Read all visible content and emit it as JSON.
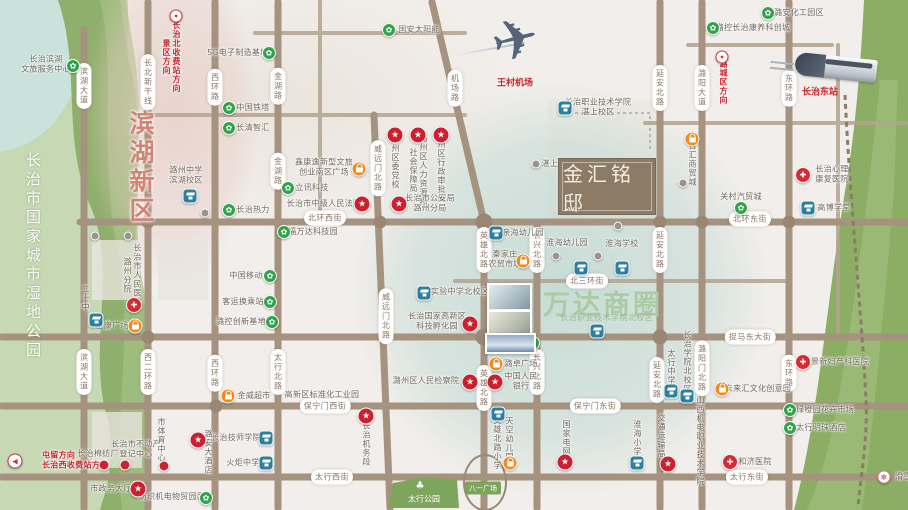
{
  "meta": {
    "width": 908,
    "height": 510
  },
  "colors": {
    "road": "#a6937f",
    "green_marker": "#33a24a",
    "blue_marker": "#2b7f9f",
    "orange_marker": "#f08a1d",
    "red_badge": "#cb2030",
    "wanda_green": "#abcba2",
    "binhu_pink": "#d08576",
    "logo_brown": "#8b7b67",
    "teal_zone": "#b0d2ca"
  },
  "title_box": {
    "name": "金汇铭邸"
  },
  "zones": {
    "binhu": "滨湖新区",
    "wetland_park": "长治市国家城市湿地公园",
    "wanda": "万达商圈",
    "wanda_sub": "长治职业技术学院北校区",
    "taihang_park": "太行公园",
    "bayi_square": "八一广场"
  },
  "transport": {
    "airport": "王村机场",
    "train_station": "长治东站"
  },
  "road_pills": [
    {
      "n": "binhu-av-1",
      "t": "滨湖大道",
      "x": 84,
      "y": 86,
      "v": 1
    },
    {
      "n": "binhu-av-2",
      "t": "滨湖大道",
      "x": 84,
      "y": 372,
      "v": 1
    },
    {
      "n": "changbei-line",
      "t": "长北新干线",
      "x": 148,
      "y": 82,
      "v": 1
    },
    {
      "n": "xierhuan-rd",
      "t": "西二环路",
      "x": 148,
      "y": 372,
      "v": 1
    },
    {
      "n": "xihuan-rd-1",
      "t": "西环路",
      "x": 215,
      "y": 87,
      "v": 1
    },
    {
      "n": "xihuan-rd-2",
      "t": "西环路",
      "x": 215,
      "y": 373,
      "v": 1
    },
    {
      "n": "jinhu-rd-1",
      "t": "金湖路",
      "x": 278,
      "y": 86,
      "v": 1
    },
    {
      "n": "jinhu-rd-2",
      "t": "金湖路",
      "x": 278,
      "y": 171,
      "v": 1
    },
    {
      "n": "taihangbei-rd",
      "t": "太行北路",
      "x": 278,
      "y": 372,
      "v": 1
    },
    {
      "n": "jichang-rd",
      "t": "机场路",
      "x": 455,
      "y": 88,
      "v": 1
    },
    {
      "n": "weiyuanmen-1",
      "t": "威远门北路",
      "x": 378,
      "y": 168,
      "v": 1
    },
    {
      "n": "weiyuanmen-2",
      "t": "威远门北路",
      "x": 386,
      "y": 316,
      "v": 1
    },
    {
      "n": "yingxiong-1",
      "t": "英雄北路",
      "x": 484,
      "y": 250,
      "v": 1
    },
    {
      "n": "yingxiong-2",
      "t": "英雄北路",
      "x": 484,
      "y": 388,
      "v": 1
    },
    {
      "n": "changxing-1",
      "t": "长兴北路",
      "x": 537,
      "y": 250,
      "v": 1
    },
    {
      "n": "changxing-2",
      "t": "长兴北路",
      "x": 537,
      "y": 372,
      "v": 1
    },
    {
      "n": "yanan-1",
      "t": "延安北路",
      "x": 660,
      "y": 88,
      "v": 1
    },
    {
      "n": "yanan-2",
      "t": "延安北路",
      "x": 660,
      "y": 250,
      "v": 1
    },
    {
      "n": "yanan-3",
      "t": "延安北路",
      "x": 657,
      "y": 380,
      "v": 1
    },
    {
      "n": "luyang-av",
      "t": "潞阳大道",
      "x": 702,
      "y": 88,
      "v": 1
    },
    {
      "n": "luyangmen-rd",
      "t": "潞阳门北路",
      "x": 702,
      "y": 368,
      "v": 1
    },
    {
      "n": "donghuan-1",
      "t": "东环路",
      "x": 789,
      "y": 88,
      "v": 1
    },
    {
      "n": "donghuan-2",
      "t": "东环路",
      "x": 789,
      "y": 373,
      "v": 1
    },
    {
      "n": "beihuan-west",
      "t": "北环西街",
      "x": 325,
      "y": 218
    },
    {
      "n": "beihuan-east",
      "t": "北环东街",
      "x": 750,
      "y": 219
    },
    {
      "n": "beisanhuan",
      "t": "北三环街",
      "x": 587,
      "y": 281
    },
    {
      "n": "zhuoma-east",
      "t": "捉马东大街",
      "x": 750,
      "y": 337
    },
    {
      "n": "baoningmen-west",
      "t": "保宁门西街",
      "x": 325,
      "y": 406
    },
    {
      "n": "baoningmen-east",
      "t": "保宁门东街",
      "x": 595,
      "y": 406
    },
    {
      "n": "taihang-west",
      "t": "太行西街",
      "x": 332,
      "y": 477
    },
    {
      "n": "taihang-east",
      "t": "太行东街",
      "x": 747,
      "y": 477
    }
  ],
  "pois": [
    {
      "n": "binhu-wenlv-center",
      "ty": "green",
      "m": [
        73,
        66
      ],
      "l": [
        46,
        64
      ],
      "lines": [
        "长治滨湖",
        "文旅服务中心"
      ]
    },
    {
      "n": "5g-base",
      "ty": "green",
      "m": [
        269,
        53
      ],
      "l": [
        238,
        53
      ],
      "t": "5G电子制造基地"
    },
    {
      "n": "guoan-solar",
      "ty": "green",
      "m": [
        389,
        30
      ],
      "l": [
        419,
        30
      ],
      "t": "国安太阳能"
    },
    {
      "n": "china-tower",
      "ty": "green",
      "m": [
        229,
        108
      ],
      "l": [
        253,
        108
      ],
      "t": "中国铁塔"
    },
    {
      "n": "changqing-zhihui",
      "ty": "green",
      "m": [
        229,
        128
      ],
      "l": [
        253,
        128
      ],
      "t": "长清智汇"
    },
    {
      "n": "lixun-tech",
      "ty": "green",
      "m": [
        288,
        188
      ],
      "l": [
        312,
        188
      ],
      "t": "立讯科技"
    },
    {
      "n": "changzhi-heating",
      "ty": "green",
      "m": [
        229,
        210
      ],
      "l": [
        253,
        210
      ],
      "t": "长治热力"
    },
    {
      "n": "china-mobile",
      "ty": "green",
      "m": [
        270,
        276
      ],
      "l": [
        246,
        276
      ],
      "t": "中国移动"
    },
    {
      "n": "transfer-hub",
      "ty": "green",
      "m": [
        270,
        302
      ],
      "l": [
        243,
        302
      ],
      "t": "客运换乘站"
    },
    {
      "n": "lukong-innovation",
      "ty": "green",
      "m": [
        272,
        322
      ],
      "l": [
        241,
        322
      ],
      "t": "潞控创新基地"
    },
    {
      "n": "fuwanda-tech",
      "ty": "green",
      "m": [
        284,
        232
      ],
      "l": [
        313,
        232
      ],
      "t": "福万达科技园"
    },
    {
      "n": "lukong-kangyang",
      "ty": "green",
      "m": [
        713,
        28
      ],
      "l": [
        753,
        28
      ],
      "t": "潞控长治康养科创城"
    },
    {
      "n": "luan-chem-park",
      "ty": "green",
      "m": [
        768,
        13
      ],
      "l": [
        799,
        13
      ],
      "t": "潞安化工园区"
    },
    {
      "n": "guancun-auto-city",
      "ty": "green",
      "m": [
        741,
        208
      ],
      "l": [
        741,
        197
      ],
      "t": "关村汽贸城"
    },
    {
      "n": "jinwei-hotel",
      "ty": "green",
      "m": [
        533,
        343
      ],
      "l": [
        509,
        343
      ],
      "t": "金威大酒店"
    },
    {
      "n": "flower-market",
      "ty": "green",
      "m": [
        790,
        410
      ],
      "l": [
        825,
        410
      ],
      "t": "绿橙园花卉市场"
    },
    {
      "n": "taihang-pearl-hotel",
      "ty": "green",
      "m": [
        790,
        428
      ],
      "l": [
        821,
        428
      ],
      "t": "太行明珠酒店"
    },
    {
      "n": "textile-trade-park",
      "ty": "green",
      "m": [
        206,
        498
      ],
      "l": [
        172,
        497
      ],
      "t": "纺织机电物贸园区"
    },
    {
      "n": "luzhou-middle-school",
      "ty": "blue",
      "m": [
        190,
        196
      ],
      "l": [
        186,
        175
      ],
      "lines": [
        "潞州中学",
        "滨湖校区"
      ]
    },
    {
      "n": "no20-middle-school",
      "ty": "blue",
      "m": [
        96,
        320
      ],
      "l": [
        85,
        298
      ],
      "t": "二十中",
      "v": 1
    },
    {
      "n": "shiyan-middle-north",
      "ty": "blue",
      "m": [
        424,
        293
      ],
      "l": [
        460,
        292
      ],
      "t": "实验中学北校区"
    },
    {
      "n": "vocational-college-zhanshang",
      "ty": "blue",
      "m": [
        565,
        108
      ],
      "l": [
        598,
        107
      ],
      "lines": [
        "长治职业技术学院",
        "湛上校区"
      ]
    },
    {
      "n": "huaihai-kindergarten",
      "ty": "blue",
      "m": [
        581,
        268
      ],
      "l": [
        567,
        243
      ],
      "t": "淮海幼儿园"
    },
    {
      "n": "huaihai-school",
      "ty": "blue",
      "m": [
        622,
        268
      ],
      "l": [
        622,
        244
      ],
      "t": "淮海学校"
    },
    {
      "n": "vocational-north-marker",
      "ty": "blue",
      "m": [
        597,
        331
      ]
    },
    {
      "n": "yingxiong-north-primary",
      "ty": "blue",
      "m": [
        498,
        414
      ],
      "l": [
        497,
        443
      ],
      "t": "英雄北路小学",
      "v": 1
    },
    {
      "n": "huaihai-primary",
      "ty": "blue",
      "m": [
        637,
        463
      ],
      "l": [
        637,
        438
      ],
      "t": "淮海小学",
      "v": 1
    },
    {
      "n": "taihang-middle",
      "ty": "blue",
      "m": [
        671,
        391
      ],
      "l": [
        671,
        367
      ],
      "t": "太行中学",
      "v": 1
    },
    {
      "n": "changzhi-college-north",
      "ty": "blue",
      "m": [
        687,
        396
      ],
      "l": [
        687,
        362
      ],
      "t": "长治学院北校区",
      "v": 1
    },
    {
      "n": "shanxi-jidian-college",
      "ty": "none",
      "l": [
        700,
        441
      ],
      "t": "山西机电职业技术学院",
      "v": 1
    },
    {
      "n": "gaobo-school",
      "ty": "blue",
      "m": [
        808,
        208
      ],
      "l": [
        834,
        208
      ],
      "t": "高博学堂"
    },
    {
      "n": "jishi-college",
      "ty": "blue",
      "m": [
        266,
        438
      ],
      "l": [
        236,
        438
      ],
      "t": "长治技师学院"
    },
    {
      "n": "huoju-middle",
      "ty": "blue",
      "m": [
        266,
        463
      ],
      "l": [
        243,
        463
      ],
      "t": "火炬中学"
    },
    {
      "n": "qinhai-kindergarten",
      "ty": "blue",
      "m": [
        496,
        233
      ],
      "l": [
        523,
        233
      ],
      "t": "亲海幼儿园"
    },
    {
      "n": "xinkangyi-plaza",
      "ty": "orange",
      "m": [
        359,
        169
      ],
      "l": [
        324,
        167
      ],
      "lines": [
        "鑫康逸新型文旅",
        "创业南区广场"
      ]
    },
    {
      "n": "hengkang-plaza",
      "ty": "orange",
      "m": [
        135,
        326
      ],
      "l": [
        112,
        326
      ],
      "t": "恒康广场"
    },
    {
      "n": "jinwei-supermarket",
      "ty": "orange",
      "m": [
        228,
        396
      ],
      "l": [
        254,
        396
      ],
      "t": "金威超市"
    },
    {
      "n": "luzhuo-plaza",
      "ty": "orange",
      "m": [
        496,
        364
      ],
      "l": [
        521,
        364
      ],
      "t": "潞卓广场"
    },
    {
      "n": "tiankong-kindergarten",
      "ty": "orange",
      "m": [
        510,
        463
      ],
      "l": [
        509,
        439
      ],
      "t": "天空幼儿园",
      "v": 1
    },
    {
      "n": "weilaihui-creative-park",
      "ty": "orange",
      "m": [
        722,
        389
      ],
      "l": [
        758,
        389
      ],
      "t": "未来汇文化创意园"
    },
    {
      "n": "baihui-trade-city",
      "ty": "orange",
      "m": [
        692,
        139
      ],
      "l": [
        692,
        164
      ],
      "t": "百汇商贸城",
      "v": 1
    },
    {
      "n": "qinjiazhuang-market",
      "ty": "orange",
      "m": [
        523,
        261
      ],
      "l": [
        505,
        259
      ],
      "lines": [
        "秦家庄",
        "农贸市场"
      ]
    },
    {
      "n": "district-party-school",
      "ty": "star",
      "m": [
        395,
        135
      ],
      "l": [
        395,
        162
      ],
      "t": "潞州区委党校",
      "v": 1
    },
    {
      "n": "hr-social-security-bureau",
      "ty": "star",
      "m": [
        418,
        135
      ],
      "l": [
        418,
        170
      ],
      "lines": [
        "潞州区人力资源和",
        "社会保障局"
      ],
      "v": 1
    },
    {
      "n": "admin-approval-bureau",
      "ty": "star",
      "m": [
        441,
        135
      ],
      "l": [
        441,
        167
      ],
      "t": "潞州区行政审批局",
      "v": 1
    },
    {
      "n": "public-security-bureau",
      "ty": "star",
      "m": [
        399,
        204
      ],
      "l": [
        430,
        203
      ],
      "lines": [
        "长治市公安局",
        "潞州分局"
      ]
    },
    {
      "n": "intermediate-court",
      "ty": "star",
      "m": [
        362,
        204
      ],
      "l": [
        324,
        204
      ],
      "t": "长治市中级人民法院"
    },
    {
      "n": "hi-tech-incubator",
      "ty": "star",
      "m": [
        470,
        324
      ],
      "l": [
        437,
        321
      ],
      "lines": [
        "长治国家高新区",
        "科技孵化园"
      ]
    },
    {
      "n": "procuratorate",
      "ty": "star",
      "m": [
        470,
        382
      ],
      "l": [
        426,
        381
      ],
      "t": "潞州区人民检察院"
    },
    {
      "n": "peoples-bank",
      "ty": "star",
      "m": [
        495,
        382
      ],
      "l": [
        521,
        381
      ],
      "lines": [
        "中国人民",
        "银行"
      ]
    },
    {
      "n": "govt-service-hall",
      "ty": "star",
      "m": [
        138,
        489
      ],
      "l": [
        111,
        489
      ],
      "t": "市政务大厅"
    },
    {
      "n": "state-grid",
      "ty": "star",
      "m": [
        565,
        462
      ],
      "l": [
        566,
        438
      ],
      "t": "国家电网",
      "v": 1
    },
    {
      "n": "transport-bureau",
      "ty": "star",
      "m": [
        668,
        464
      ],
      "l": [
        661,
        436
      ],
      "t": "交通运输局",
      "v": 1
    },
    {
      "n": "jiwuduan",
      "ty": "star",
      "m": [
        366,
        416
      ],
      "l": [
        366,
        444
      ],
      "t": "长治机务段",
      "v": 1
    },
    {
      "n": "luan-hotel",
      "ty": "star",
      "m": [
        198,
        440
      ],
      "l": [
        208,
        452
      ],
      "t": "潞安大酒店",
      "v": 1
    },
    {
      "n": "peoples-hospital-luzhou",
      "ty": "cross",
      "m": [
        134,
        305
      ],
      "l": [
        132,
        275
      ],
      "lines": [
        "长治市人民医院",
        "潞州分院"
      ],
      "v": 1
    },
    {
      "n": "xinli-rehab-hospital",
      "ty": "cross",
      "m": [
        803,
        175
      ],
      "l": [
        832,
        174
      ],
      "lines": [
        "长治心理",
        "康复医院"
      ]
    },
    {
      "n": "jingxin-hospital",
      "ty": "cross",
      "m": [
        803,
        362
      ],
      "l": [
        840,
        362
      ],
      "t": "景新妇产科医院"
    },
    {
      "n": "heji-hospital",
      "ty": "cross",
      "m": [
        730,
        462
      ],
      "l": [
        755,
        462
      ],
      "t": "和济医院"
    },
    {
      "n": "mianfang-plant",
      "ty": "reddot",
      "m": [
        104,
        465
      ],
      "l": [
        98,
        454
      ],
      "t": "长治棉纺厂"
    },
    {
      "n": "real-estate-registry",
      "ty": "reddot",
      "m": [
        125,
        465
      ],
      "l": [
        136,
        449
      ],
      "lines": [
        "长治市不动产",
        "登记中心"
      ]
    },
    {
      "n": "sports-center",
      "ty": "reddot",
      "m": [
        164,
        466
      ],
      "l": [
        161,
        440
      ],
      "t": "市体育中心",
      "v": 1
    },
    {
      "n": "zhanshang-village",
      "ty": "gray",
      "m": [
        536,
        164
      ],
      "l": [
        554,
        164
      ],
      "t": "湛上村"
    },
    {
      "n": "hwy-north-toll",
      "ty": "hwy",
      "m": [
        176,
        16
      ],
      "l": [
        171,
        57
      ],
      "lines": [
        "长治北收费站方向",
        "景区方向"
      ],
      "v": 1,
      "red": 1
    },
    {
      "n": "hwy-lucheng-dir",
      "ty": "hwy",
      "m": [
        722,
        57
      ],
      "l": [
        723,
        82
      ],
      "t": "潞城区方向",
      "v": 1,
      "red": 1
    },
    {
      "n": "arrow-west-toll",
      "ty": "arrow",
      "m": [
        15,
        461
      ],
      "l": [
        42,
        460
      ],
      "lines": [
        "屯留方向",
        "长治西收费站方向"
      ],
      "red": 1,
      "anchor": "left"
    },
    {
      "n": "ski-resort",
      "ty": "ski",
      "m": [
        884,
        477
      ],
      "l": [
        895,
        477
      ],
      "t": "滑雪场",
      "anchor": "left"
    },
    {
      "n": "industrial-park-std",
      "ty": "none",
      "l": [
        322,
        395
      ],
      "t": "高新区标准化工业园"
    }
  ],
  "gray_dots": [
    [
      205,
      213
    ],
    [
      95,
      236
    ],
    [
      128,
      236
    ],
    [
      556,
      256
    ],
    [
      598,
      256
    ],
    [
      683,
      183
    ],
    [
      618,
      226
    ]
  ],
  "intersections": [
    [
      148,
      222,
      13
    ],
    [
      380,
      222,
      13
    ],
    [
      484,
      222,
      17
    ],
    [
      660,
      222,
      13
    ],
    [
      702,
      222,
      13
    ],
    [
      789,
      222,
      13
    ],
    [
      148,
      337,
      13
    ],
    [
      484,
      337,
      17
    ],
    [
      660,
      337,
      15
    ],
    [
      216,
      406,
      13
    ]
  ]
}
